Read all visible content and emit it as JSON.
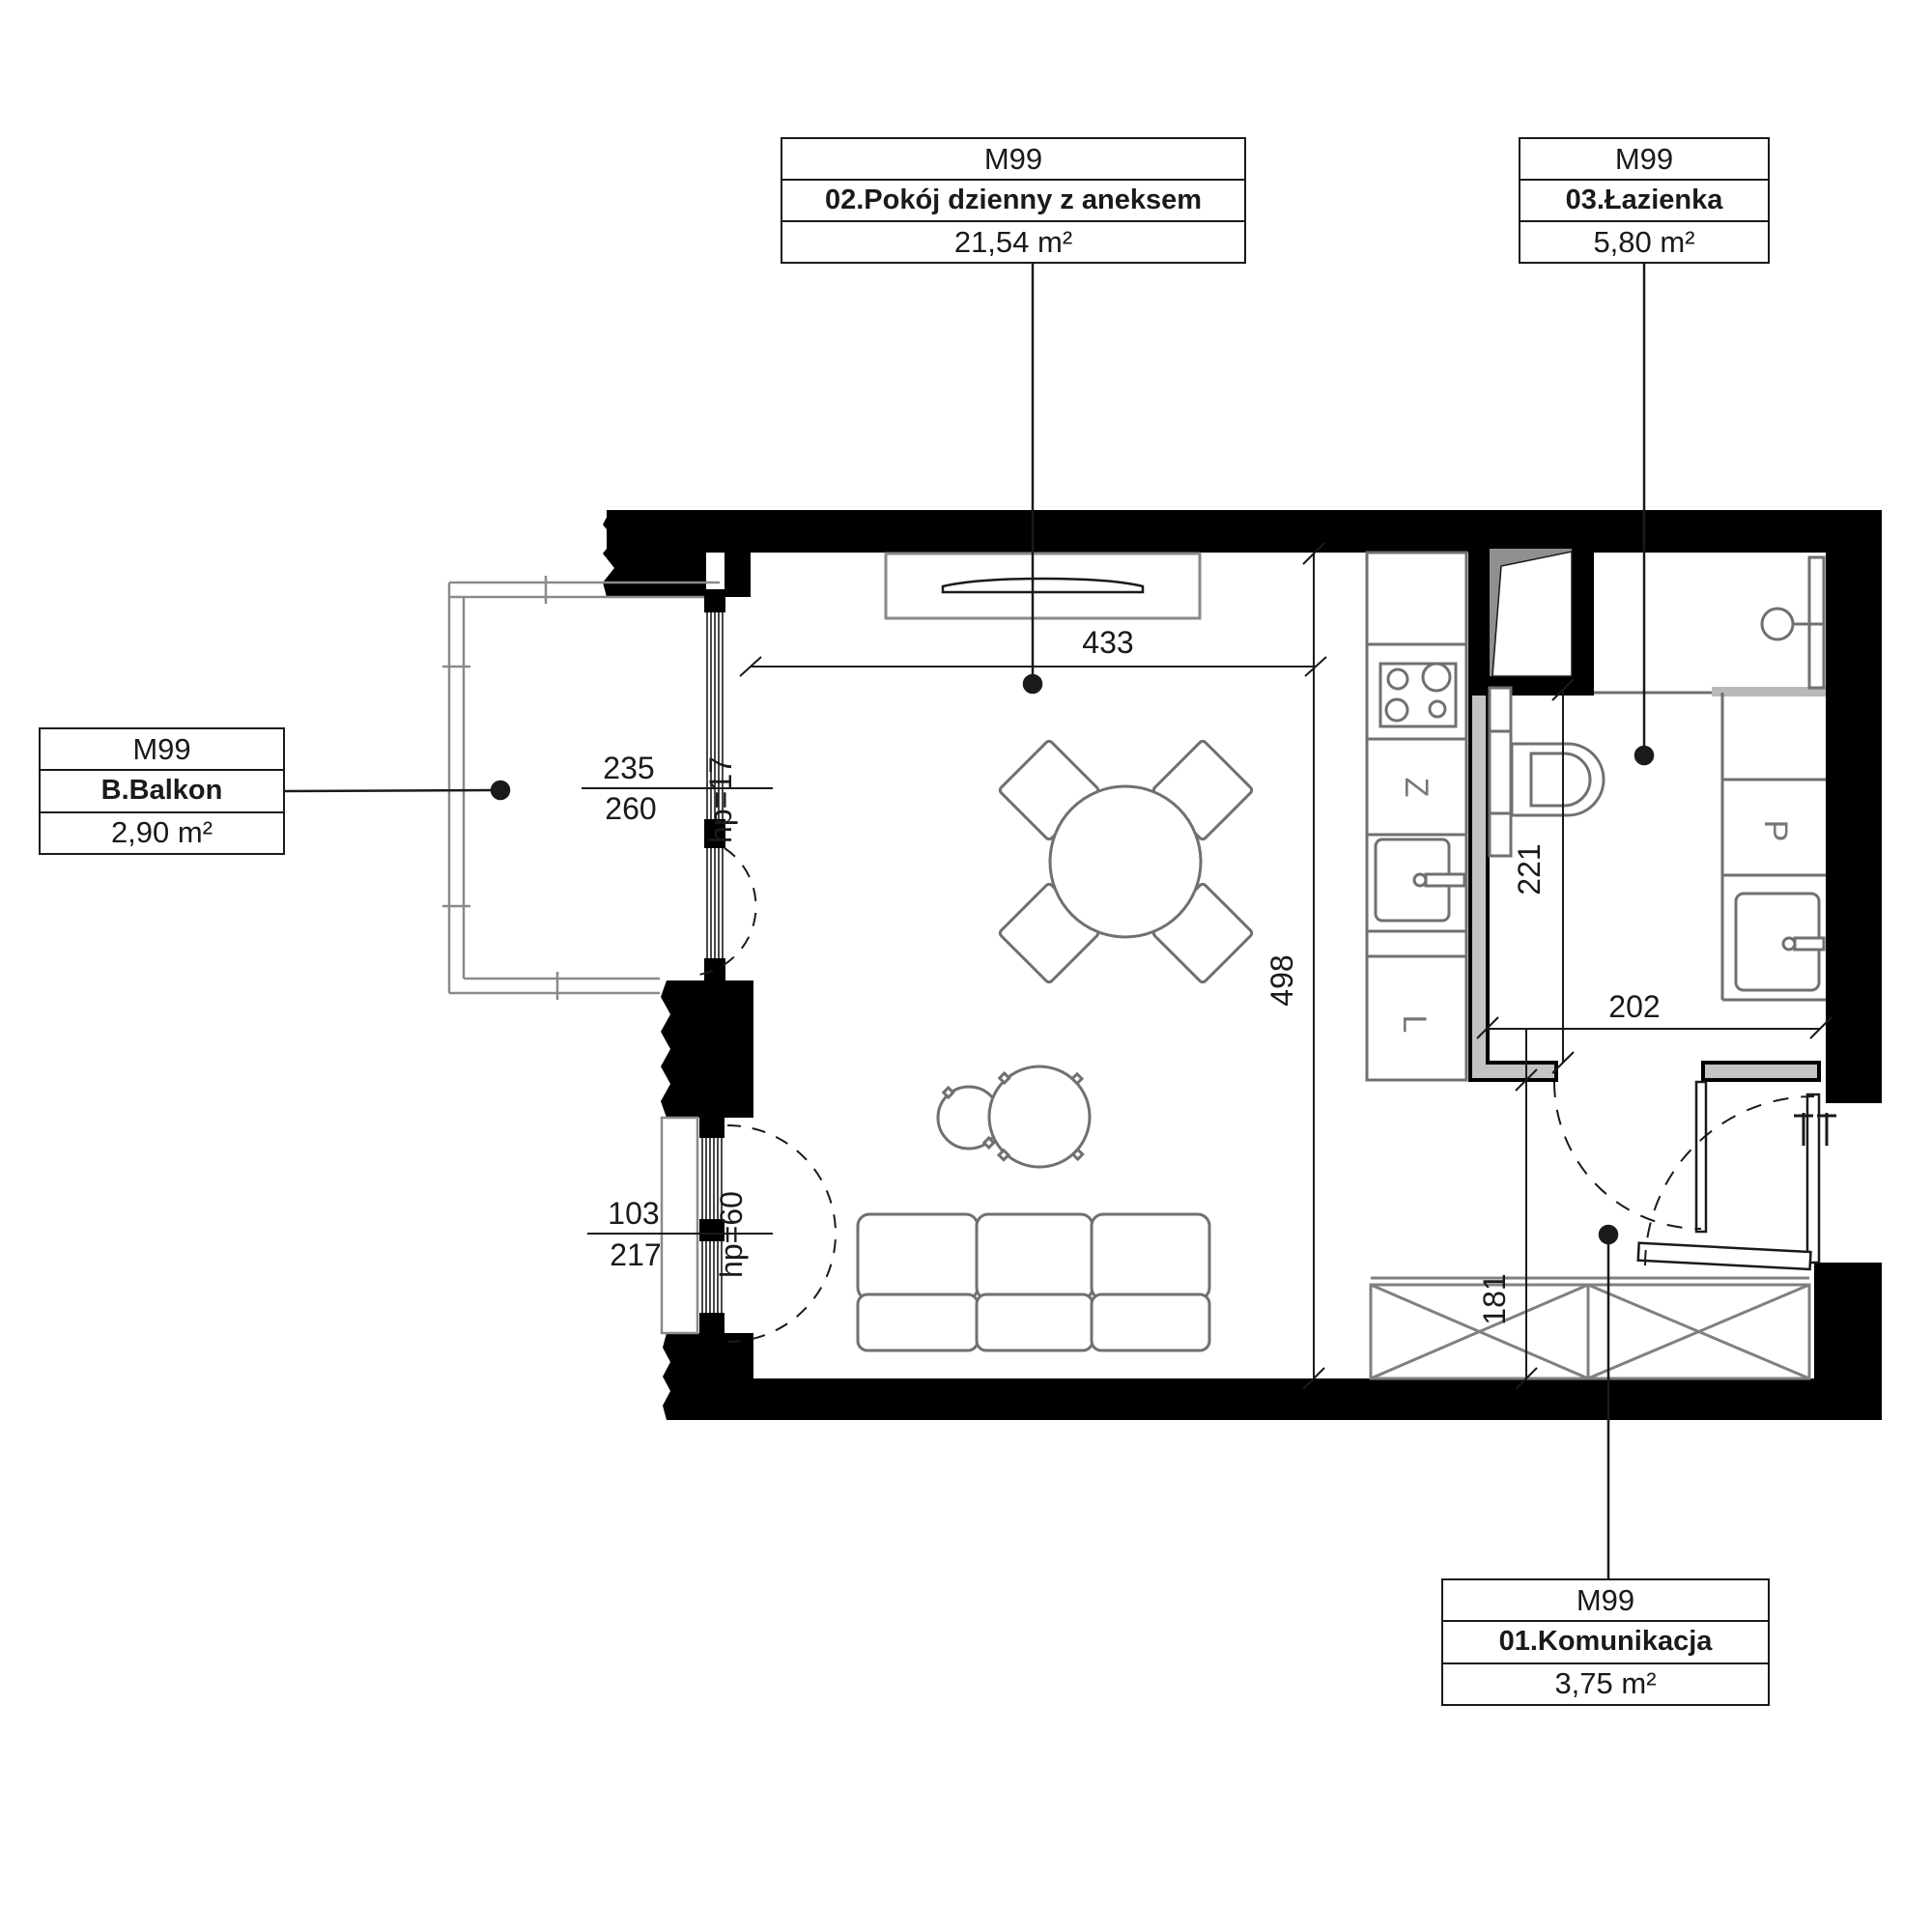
{
  "labels": {
    "living": {
      "unit": "M99",
      "name": "02.Pokój dzienny z aneksem",
      "area": "21,54 m²"
    },
    "bathroom": {
      "unit": "M99",
      "name": "03.Łazienka",
      "area": "5,80 m²"
    },
    "balcony": {
      "unit": "M99",
      "name": "B.Balkon",
      "area": "2,90 m²"
    },
    "hallway": {
      "unit": "M99",
      "name": "01.Komunikacja",
      "area": "3,75 m²"
    }
  },
  "dimensions": {
    "top_window_width": "433",
    "room_depth": "498",
    "balcony_door_width": "235",
    "balcony_door_width_total": "260",
    "balcony_door_sill": "hp=17",
    "low_window_width": "103",
    "low_window_width_total": "217",
    "low_window_sill": "hp=60",
    "bathroom_depth": "221",
    "bathroom_width": "202",
    "hallway_depth": "181"
  },
  "appliances": {
    "dishwasher": "Z",
    "fridge": "L",
    "washer": "P"
  },
  "colors": {
    "wall": "#000000",
    "furniture_stroke": "#707070",
    "partition_fill": "#c3c3c3",
    "shaft_fill": "#8f8f8f",
    "line": "#1a1a1a"
  }
}
